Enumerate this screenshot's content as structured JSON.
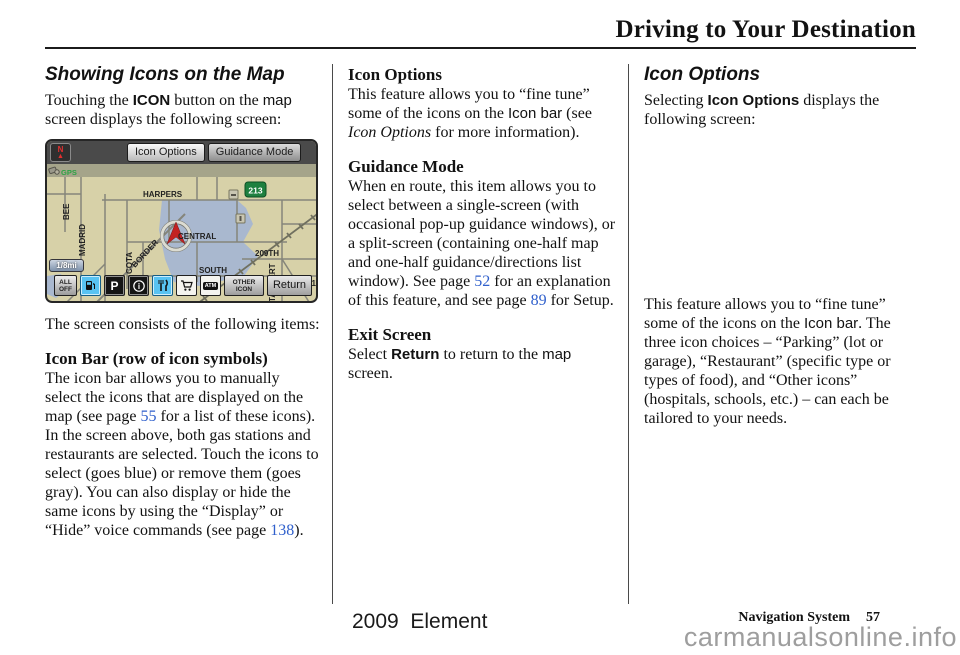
{
  "page": {
    "title": "Driving to Your Destination",
    "footer": {
      "model": "2009  Element",
      "section": "Navigation System",
      "page_number": "57",
      "watermark": "carmanualsonline.info"
    }
  },
  "left_column": {
    "heading": "Showing Icons on the Map",
    "intro": [
      {
        "t": "Touching the "
      },
      {
        "t": "ICON",
        "s": "uib"
      },
      {
        "t": " button on the "
      },
      {
        "t": "map",
        "s": "ui"
      },
      {
        "t": " screen displays the following screen:"
      }
    ],
    "consists": "The screen consists of the following items:",
    "iconbar_heading": "Icon Bar (row of icon symbols)",
    "iconbar_body": [
      {
        "t": "The icon bar allows you to manually select the icons that are displayed on the map (see page "
      },
      {
        "t": "55",
        "s": "pg"
      },
      {
        "t": " for a list of these icons). In the screen above, both gas stations and restaurants are selected. Touch the icons to select (goes blue) or remove them  (goes gray). You can also display or hide the same icons by using the “Display” or “Hide” voice commands (see page "
      },
      {
        "t": "138",
        "s": "pg"
      },
      {
        "t": ")."
      }
    ]
  },
  "middle_column": {
    "icon_options_heading": "Icon Options",
    "icon_options_body": [
      {
        "t": "This feature allows you to “fine tune” some of the icons on the "
      },
      {
        "t": "Icon bar",
        "s": "ui"
      },
      {
        "t": " (see "
      },
      {
        "t": "Icon Options",
        "s": "i"
      },
      {
        "t": " for more information)."
      }
    ],
    "guidance_heading": "Guidance Mode",
    "guidance_body": [
      {
        "t": "When en route, this item allows you to select between a single-screen (with occasional pop-up guidance windows), or a split-screen (containing one-half map and one-half guidance/directions list window). See page "
      },
      {
        "t": "52",
        "s": "pg"
      },
      {
        "t": " for an explanation of this feature, and see page "
      },
      {
        "t": "89",
        "s": "pg"
      },
      {
        "t": " for Setup."
      }
    ],
    "exit_heading": "Exit Screen",
    "exit_body": [
      {
        "t": "Select "
      },
      {
        "t": "Return",
        "s": "uib"
      },
      {
        "t": " to return to the "
      },
      {
        "t": "map",
        "s": "ui"
      },
      {
        "t": " screen."
      }
    ]
  },
  "right_column": {
    "heading": "Icon Options",
    "intro": [
      {
        "t": "Selecting "
      },
      {
        "t": "Icon Options",
        "s": "uib"
      },
      {
        "t": " displays the following screen:"
      }
    ],
    "body": [
      {
        "t": "This feature allows you to “fine tune” some of the icons on the "
      },
      {
        "t": "Icon bar",
        "s": "ui"
      },
      {
        "t": ". The three icon choices – “Parking” (lot or garage), “Restaurant” (specific type or types of food), and “Other icons” (hospitals, schools, etc.) – can each be tailored to your needs."
      }
    ]
  },
  "map": {
    "north_label": "N",
    "north_arrow": "▲",
    "buttons": {
      "icon_options": "Icon Options",
      "guidance_mode": "Guidance Mode"
    },
    "gps_label": "GPS",
    "scale_label": "1/8mi",
    "shield_label": "213",
    "labels": {
      "harpers": "HARPERS",
      "central": "CENTRAL",
      "south": "SOUTH",
      "street_209": "209TH",
      "street_211": "211T",
      "madrid": "MADRID",
      "bee": "BEE",
      "cota": "COTA",
      "border": "BORDER",
      "taggert": "TAGGERT"
    },
    "icon_bar": {
      "all_off_line1": "ALL",
      "all_off_line2": "OFF",
      "parking_label": "P",
      "info_label": "i",
      "atm_label": "ATM",
      "other_icon_line1": "OTHER",
      "other_icon_line2": "ICON",
      "return_label": "Return"
    },
    "colors": {
      "map_tan": "#d7d1a8",
      "urban_blue": "#a9b8cf",
      "selected_blue": "#58c3f2",
      "shield_green": "#1e8040",
      "arrow_red": "#c32222",
      "link_blue": "#3060cc"
    }
  }
}
